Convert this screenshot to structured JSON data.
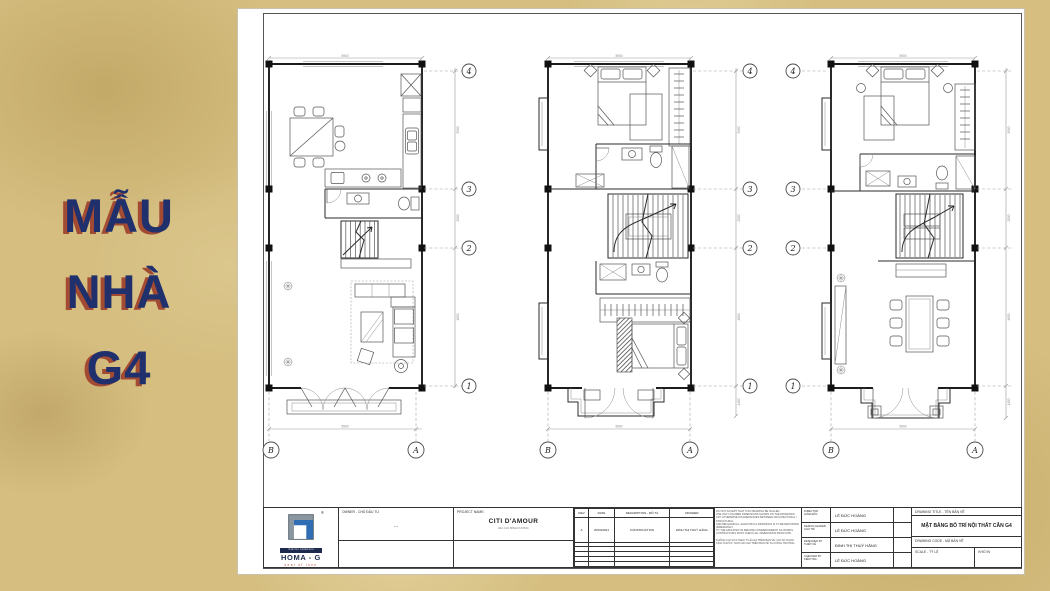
{
  "slide": {
    "background_color": "#d5be80",
    "title": {
      "lines": [
        "MẪU",
        "NHÀ",
        "G4"
      ],
      "color": "#20306d",
      "shadow_color": "#a34a33"
    }
  },
  "sheet": {
    "plans": [
      {
        "id": "first-floor",
        "grid_rows": [
          "4",
          "3",
          "2",
          "1"
        ],
        "grid_cols": [
          "B",
          "A"
        ],
        "dims_right": [
          "3900",
          "2000",
          "4600"
        ],
        "dim_bottom": "5900",
        "dim_top": "5900"
      },
      {
        "id": "second-floor",
        "grid_rows": [
          "4",
          "3",
          "2",
          "1"
        ],
        "grid_cols": [
          "B",
          "A"
        ],
        "dims_right": [
          "3900",
          "2000",
          "4600"
        ],
        "dim_bottom": "5900",
        "dim_top": "5900",
        "dim_balcony": "1400"
      },
      {
        "id": "third-floor",
        "grid_rows": [
          "4",
          "3",
          "2",
          "1"
        ],
        "grid_cols": [
          "B",
          "A"
        ],
        "dims_right": [
          "3900",
          "2000",
          "4600"
        ],
        "dim_bottom": "5900",
        "dim_top": "5900",
        "dim_balcony": "1400"
      }
    ],
    "title_block": {
      "logo": {
        "reg": "®",
        "small_line": "interior solutions",
        "brand": "HOMA - G",
        "tagline": "seal of love"
      },
      "owner": {
        "label": "OWNER - CHỦ ĐẦU TƯ",
        "value": "..."
      },
      "project": {
        "label": "PROJECT NAME:",
        "name": "CITI D'AMOUR",
        "address": "ĐỊA CHỈ: BÌNH DƯƠNG"
      },
      "revision": {
        "headers": [
          "REV",
          "DATE",
          "DESCRIPTION - MÔ TẢ",
          "DRAWER"
        ],
        "rows": [
          [
            "A",
            "20/03/2021",
            "CONSTRUCTION",
            "ĐINH THỊ THUỲ HẰNG"
          ]
        ]
      },
      "notes": {
        "para1": [
          "DO NOT ACCEPT THAT THIS DRAWING BE SCALED.",
          "USE ONLY FIGURED DIMENSIONS SHOWN ON THE DRAWINGS.",
          "ANY OTHERWISE DISCREPANCIES BETWEEN ARCHITECTURAL / STRUCTURAL",
          "AND MECHANICAL / ELECTRICAL DRAWINGS IS TO BE REPORTED IMMEDIATELY",
          "TO THE ARCHITECT/S BEFORE COMMENCEMENT OF WORKS.",
          "CONTRACTORS MUST CHECK ALL DIMENSIONS FROM SITE."
        ],
        "para2": [
          "KHÔNG CHỈ SỬA THEO TỈ LỆ GHI TRÊN BẢN VẼ, CHỈ SỬ DỤNG",
          "KÍCH THƯỚC THỰC ĐO GHI TRÊN BẢN VẼ TẠI CÔNG TRƯỜNG."
        ]
      },
      "personnel": [
        {
          "label_en": "DIRECTOR",
          "label_vi": "GIÁM ĐỐC",
          "name": "LÊ ĐỨC HOÀNG"
        },
        {
          "label_en": "DESIGN LEADER",
          "label_vi": "CHỦ TRÌ",
          "name": "LÊ ĐỨC HOÀNG"
        },
        {
          "label_en": "DESIGNED BY",
          "label_vi": "THIẾT KẾ",
          "name": "ĐINH THỊ THUỲ HẰNG"
        },
        {
          "label_en": "CHECKED BY",
          "label_vi": "KIỂM TRA",
          "name": "LÊ ĐỨC HOÀNG"
        }
      ],
      "drawing": {
        "title_label": "DRAWING TITLE - TÊN BẢN VẼ",
        "title": "MẶT BẰNG BỐ TRÍ NỘI THẤT CĂN G4",
        "code_label": "DRAWING CODE - MÃ BẢN VẼ",
        "scale_label": "SCALE - TỶ LỆ",
        "paper_label": "KHỔ IN"
      }
    }
  }
}
